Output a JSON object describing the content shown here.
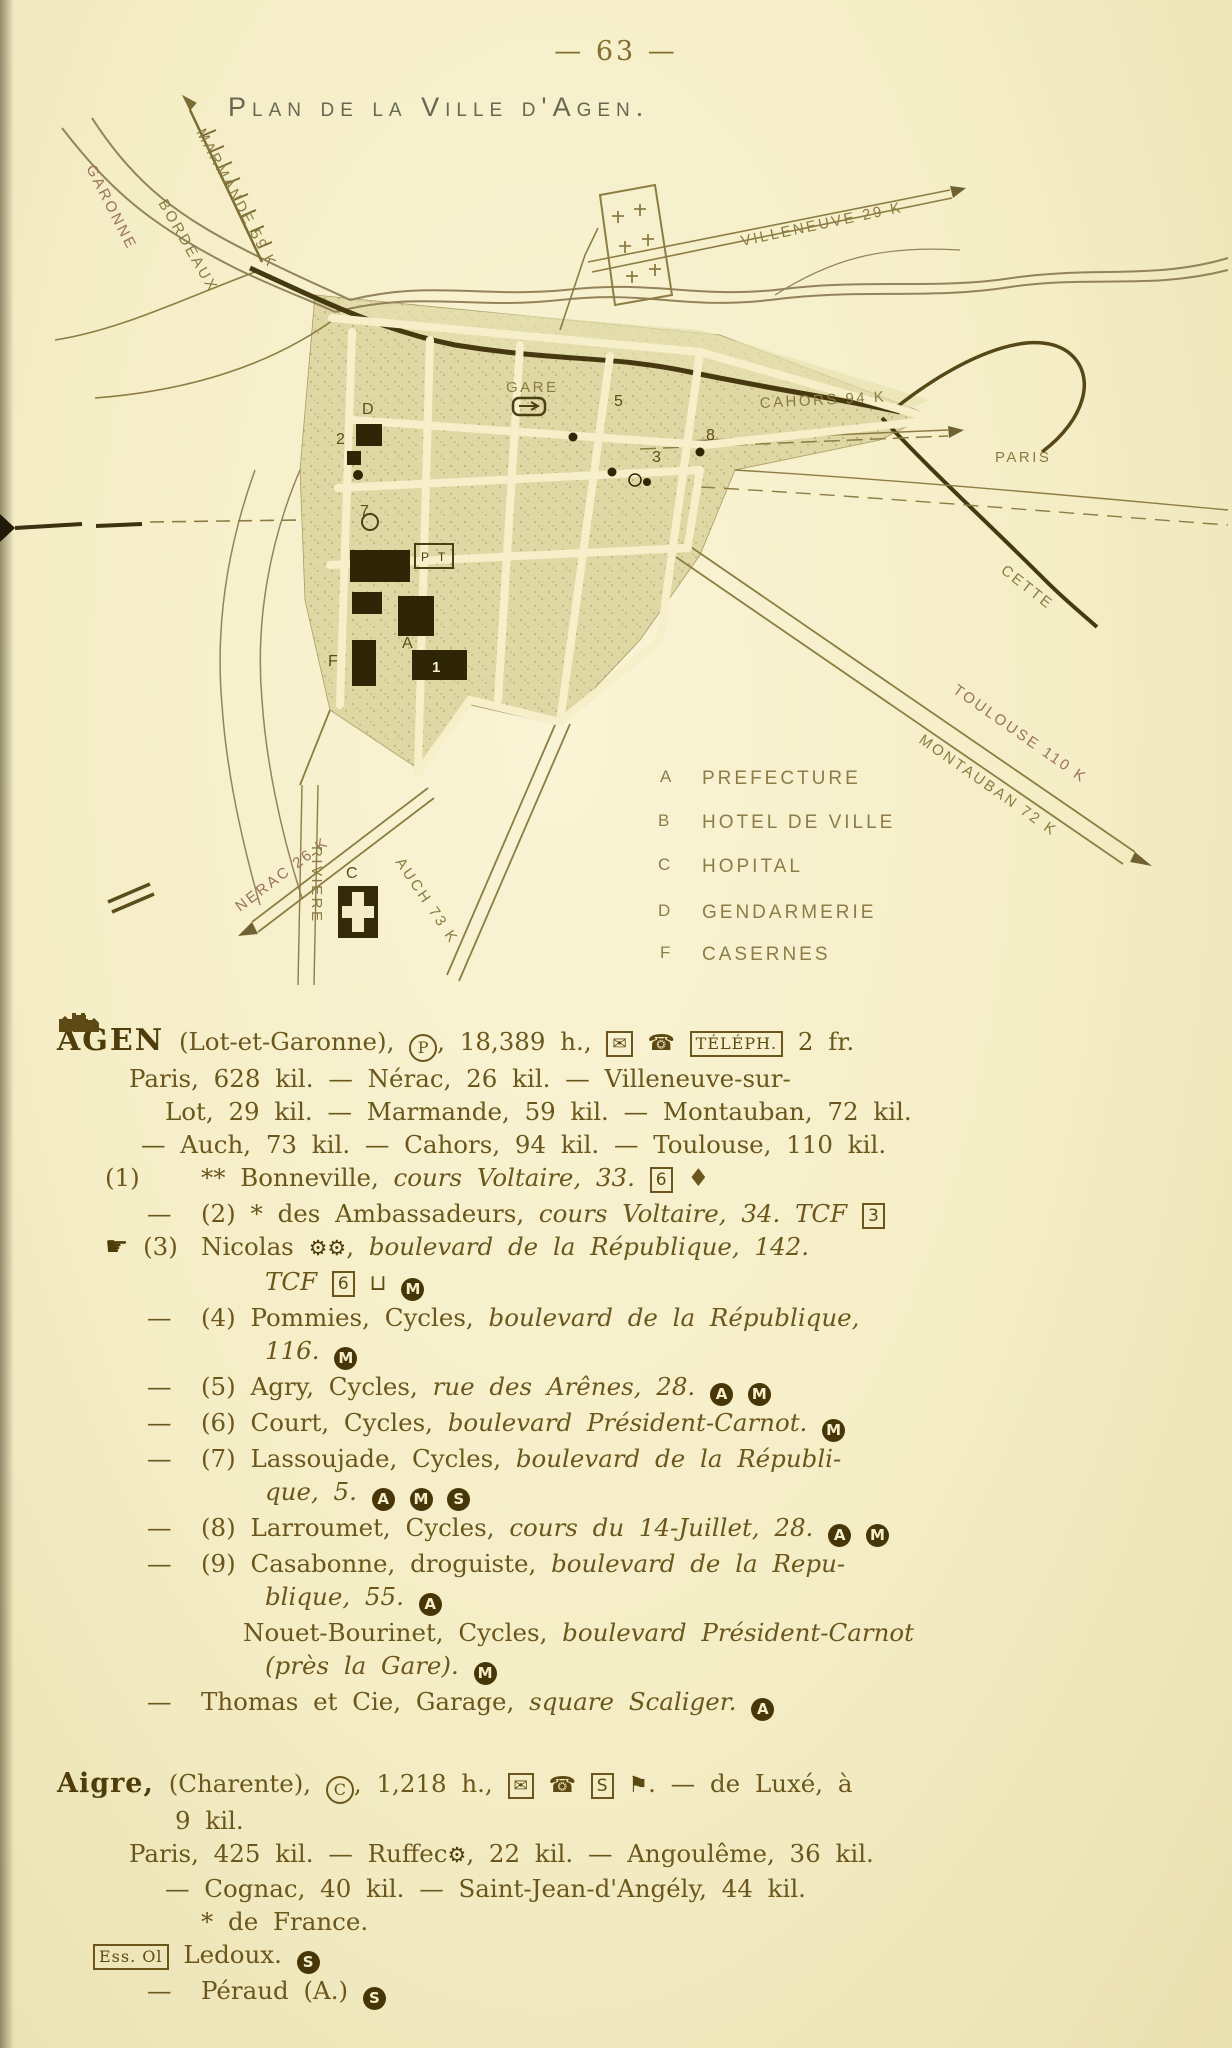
{
  "page_number": "— 63 —",
  "map": {
    "title": "Plan de la Ville d'Agen.",
    "labels": {
      "garonne": "GARONNE",
      "bordeaux": "BORDEAUX",
      "marmande": "MARMANDE 59 K",
      "villeneuve": "VILLENEUVE 29 K",
      "cahors": "CAHORS 94 K",
      "paris": "PARIS",
      "cette": "CETTE",
      "toulouse": "TOULOUSE 110 K",
      "montauban": "MONTAUBAN 72 K",
      "nerac": "NERAC 26 K",
      "auch": "AUCH 73 K",
      "riviere": "RIVIERE",
      "gare": "GARE",
      "pt": "P T"
    },
    "markers": {
      "a": "A",
      "c": "C",
      "d": "D",
      "f": "F",
      "n1": "1",
      "n2": "2",
      "n3": "3",
      "n5": "5",
      "n7": "7",
      "n8": "8"
    },
    "legend_rows": [
      {
        "key": "A",
        "label": "PREFECTURE"
      },
      {
        "key": "B",
        "label": "HOTEL DE VILLE"
      },
      {
        "key": "C",
        "label": "HOPITAL"
      },
      {
        "key": "D",
        "label": "GENDARMERIE"
      },
      {
        "key": "F",
        "label": "CASERNES"
      }
    ]
  },
  "agen": {
    "name": "AGEN",
    "dept": "(Lot-et-Garonne),",
    "post_symbol": "P",
    "population": "18,389 h.,",
    "telegraph_symbol": "✉",
    "telephone_symbol": "☎",
    "teleph_box": "TÉLÉPH.",
    "fee": "2 fr.",
    "distances": [
      "Paris, 628 kil. — Nérac, 26 kil. — Villeneuve-sur-",
      "Lot, 29 kil. — Marmande, 59 kil. — Montauban, 72 kil.",
      "— Auch, 73 kil. — Cahors, 94 kil. — Toulouse, 110 kil."
    ],
    "listings": [
      {
        "num": "(1)",
        "stars": "**",
        "name": "Bonneville,",
        "addr": "cours Voltaire, 33.",
        "box": "6",
        "gem": "♦"
      },
      {
        "dash": "—",
        "num": "(2)",
        "stars": "*",
        "name": "des Ambassadeurs,",
        "addr": "cours Voltaire, 34.",
        "tcf": "TCF",
        "box": "3"
      },
      {
        "lead_symbol": "☛",
        "num": "(3)",
        "name": "Nicolas",
        "gear1": "⚙",
        "gear2": "⚙",
        "sep": ",",
        "addr": "boulevard de la République, 142."
      },
      {
        "tcf": "TCF",
        "box": "6",
        "cup": "⊔",
        "disc1": "M"
      },
      {
        "dash": "—",
        "num": "(4)",
        "name": "Pommies, Cycles,",
        "addr": "boulevard de la République,"
      },
      {
        "addr": "116.",
        "disc1": "M"
      },
      {
        "dash": "—",
        "num": "(5)",
        "name": "Agry, Cycles,",
        "addr": "rue des Arênes, 28.",
        "disc1": "A",
        "disc2": "M"
      },
      {
        "dash": "—",
        "num": "(6)",
        "name": "Court, Cycles,",
        "addr": "boulevard Président-Carnot.",
        "disc1": "M"
      },
      {
        "dash": "—",
        "num": "(7)",
        "name": "Lassoujade, Cycles,",
        "addr": "boulevard de la Républi-"
      },
      {
        "addr": "que, 5.",
        "disc1": "A",
        "disc2": "M",
        "disc3": "S"
      },
      {
        "dash": "—",
        "num": "(8)",
        "name": "Larroumet, Cycles,",
        "addr": "cours du 14-Juillet, 28.",
        "disc1": "A",
        "disc2": "M"
      },
      {
        "dash": "—",
        "num": "(9)",
        "name": "Casabonne, droguiste,",
        "addr": "boulevard de la Repu-"
      },
      {
        "addr": "blique, 55.",
        "disc1": "A"
      },
      {
        "name": "Nouet-Bourinet, Cycles,",
        "addr": "boulevard Président-Carnot"
      },
      {
        "addr": "(près la Gare).",
        "disc1": "M"
      },
      {
        "dash": "—",
        "name": "Thomas et Cie, Garage,",
        "addr": "square Scaliger.",
        "disc1": "A"
      }
    ]
  },
  "aigre": {
    "name": "Aigre,",
    "dept": "(Charente),",
    "c_symbol": "C",
    "population": "1,218 h.,",
    "telegraph_symbol": "✉",
    "telephone_symbol": "☎",
    "box_s": "S",
    "signal_symbol": "⚑",
    "sep": ". —",
    "rail_tail": "de Luxé, à",
    "tail2": "9 kil.",
    "dist1a": "Paris, 425 kil. — Ruffec",
    "gear": "⚙",
    "dist1b": ", 22 kil. — Angoulême, 36 kil.",
    "dist2": "— Cognac, 40 kil. — Saint-Jean-d'Angély, 44 kil.",
    "hotel_star": "*",
    "hotel_name": "de France.",
    "ess_box": "Ess. Ol",
    "ess_name": "Ledoux.",
    "ess_disc": "S",
    "last_dash": "—",
    "last_name": "Péraud (A.)",
    "last_disc": "S"
  }
}
